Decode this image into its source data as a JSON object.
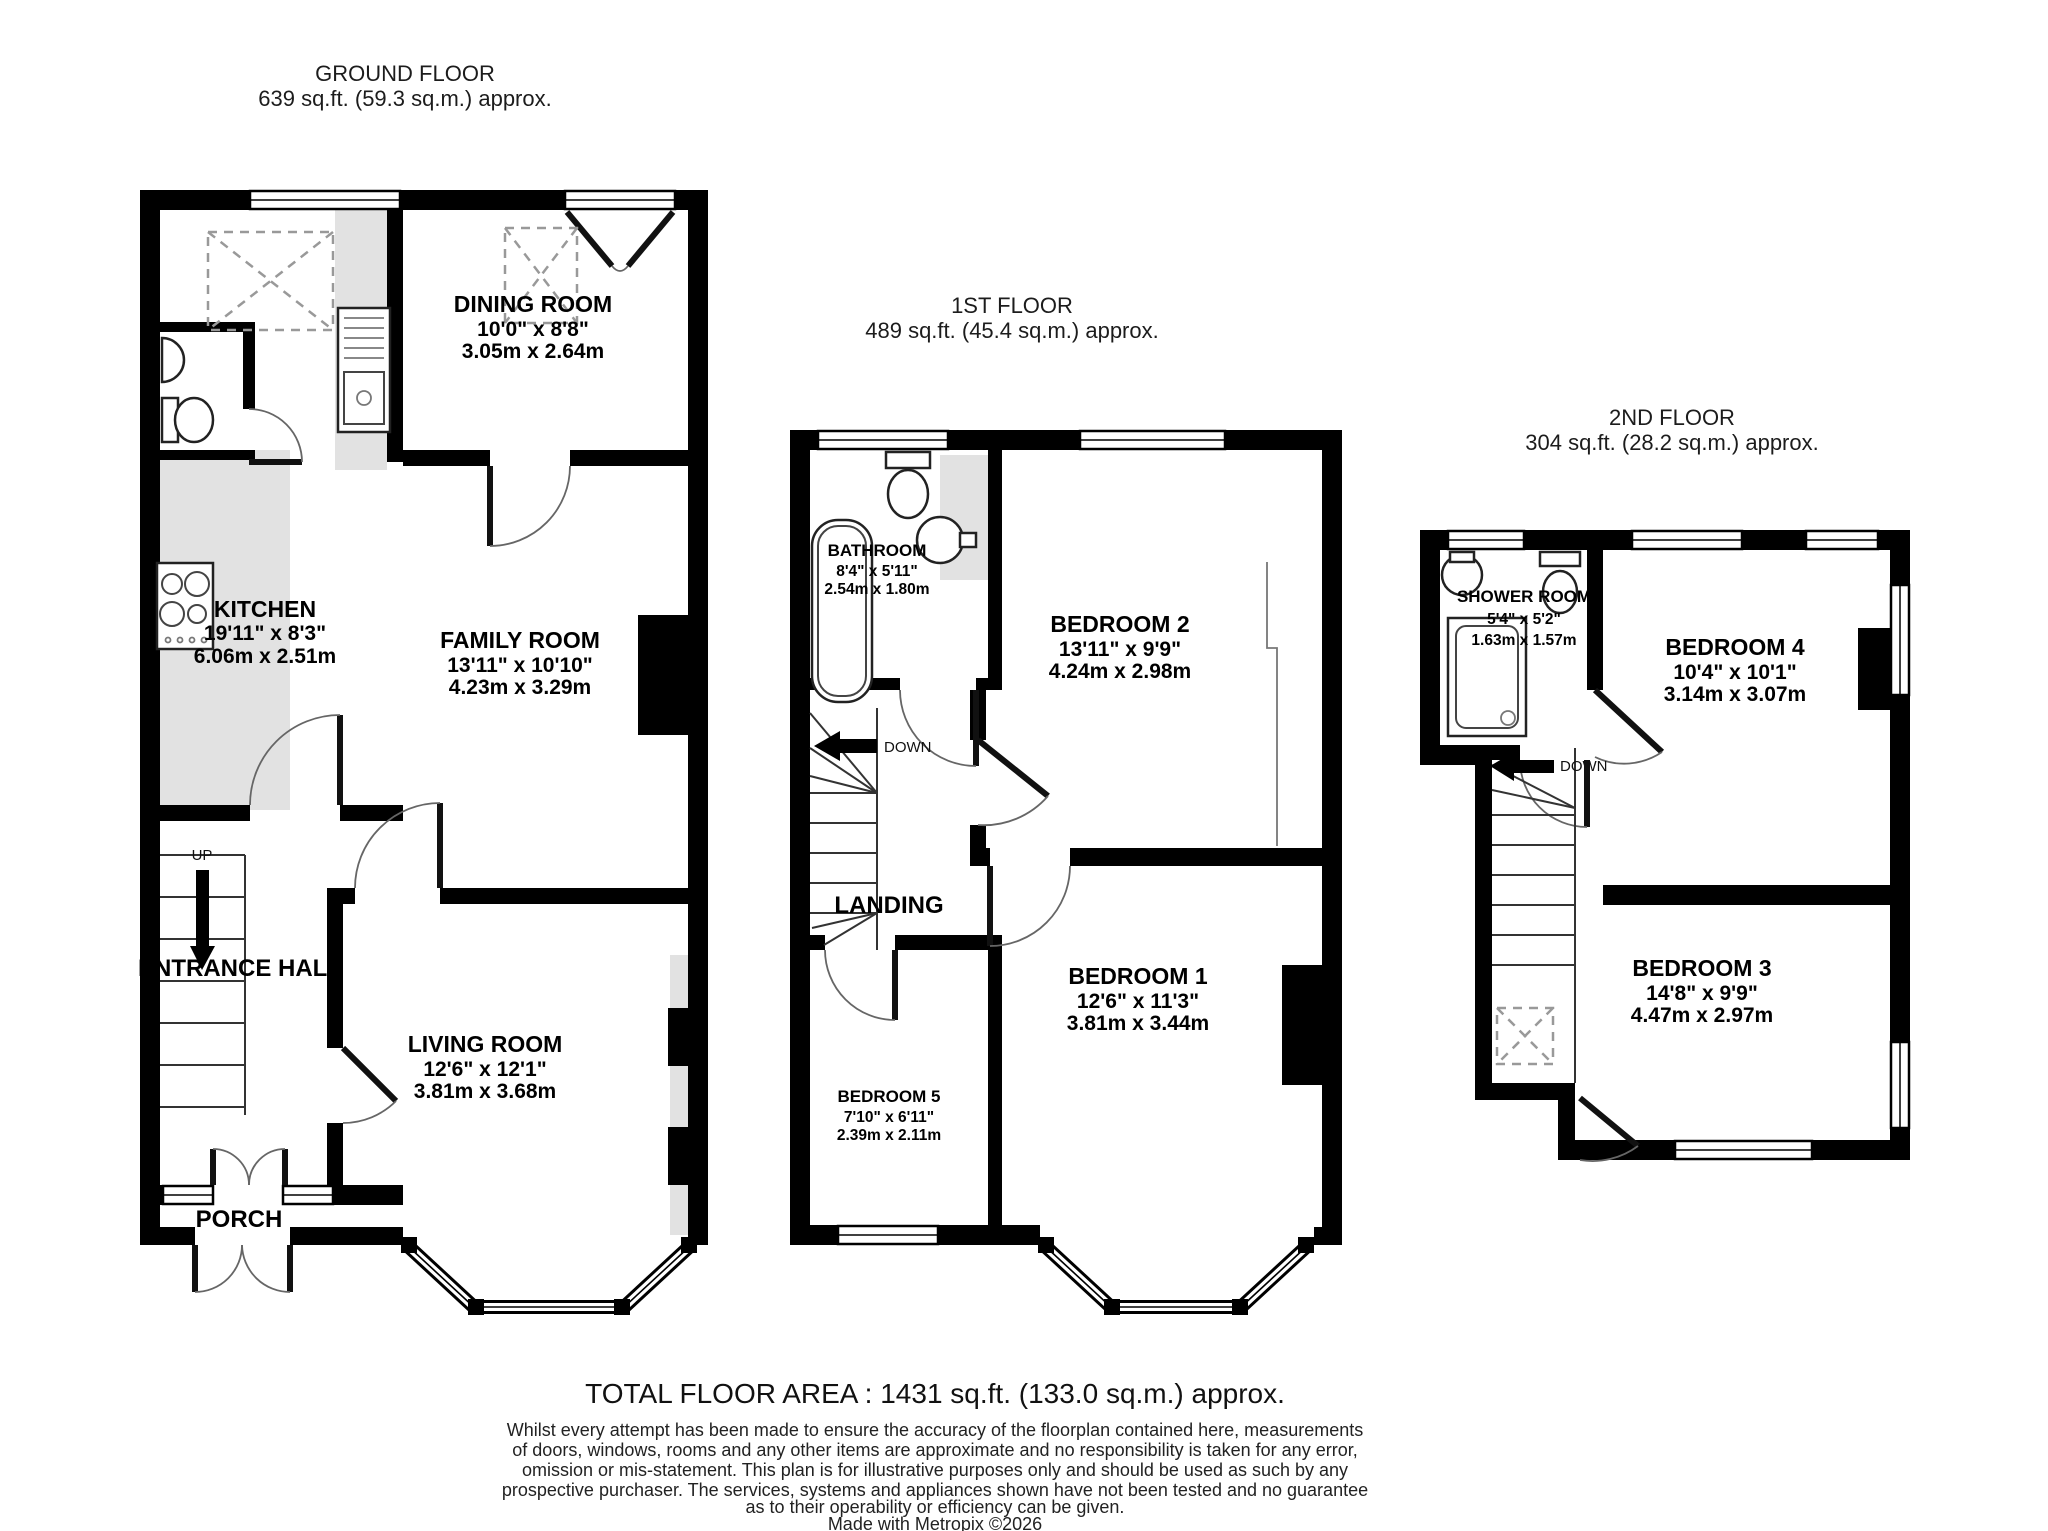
{
  "floors": [
    {
      "title": "GROUND FLOOR",
      "area": "639 sq.ft. (59.3 sq.m.) approx.",
      "stair_label": "UP",
      "rooms": [
        {
          "name": "DINING ROOM",
          "imperial": "10'0\"  x 8'8\"",
          "metric": "3.05m  x 2.64m"
        },
        {
          "name": "KITCHEN",
          "imperial": "19'11\"  x 8'3\"",
          "metric": "6.06m  x 2.51m"
        },
        {
          "name": "FAMILY ROOM",
          "imperial": "13'11\"  x 10'10\"",
          "metric": "4.23m  x 3.29m"
        },
        {
          "name": "ENTRANCE HALL"
        },
        {
          "name": "LIVING ROOM",
          "imperial": "12'6\"  x 12'1\"",
          "metric": "3.81m  x 3.68m"
        },
        {
          "name": "PORCH"
        }
      ]
    },
    {
      "title": "1ST FLOOR",
      "area": "489 sq.ft. (45.4 sq.m.) approx.",
      "stair_label": "DOWN",
      "landing_label": "LANDING",
      "rooms": [
        {
          "name": "BATHROOM",
          "imperial": "8'4\"  x 5'11\"",
          "metric": "2.54m  x 1.80m"
        },
        {
          "name": "BEDROOM 2",
          "imperial": "13'11\"  x 9'9\"",
          "metric": "4.24m  x 2.98m"
        },
        {
          "name": "BEDROOM 1",
          "imperial": "12'6\"  x 11'3\"",
          "metric": "3.81m  x 3.44m"
        },
        {
          "name": "BEDROOM 5",
          "imperial": "7'10\"  x 6'11\"",
          "metric": "2.39m  x 2.11m"
        }
      ]
    },
    {
      "title": "2ND FLOOR",
      "area": "304 sq.ft. (28.2 sq.m.) approx.",
      "stair_label": "DOWN",
      "rooms": [
        {
          "name": "SHOWER ROOM",
          "imperial": "5'4\"  x 5'2\"",
          "metric": "1.63m  x 1.57m"
        },
        {
          "name": "BEDROOM 4",
          "imperial": "10'4\"  x 10'1\"",
          "metric": "3.14m  x 3.07m"
        },
        {
          "name": "BEDROOM 3",
          "imperial": "14'8\"  x 9'9\"",
          "metric": "4.47m  x 2.97m"
        }
      ]
    }
  ],
  "footer": {
    "total": "TOTAL FLOOR AREA : 1431 sq.ft. (133.0 sq.m.) approx.",
    "disclaimer": [
      "Whilst every attempt has been made to ensure the accuracy of the floorplan contained here, measurements",
      "of doors, windows, rooms and any other items are approximate and no responsibility is taken for any error,",
      "omission or mis-statement. This plan is for illustrative purposes only and should be used as such by any",
      "prospective purchaser. The services, systems and appliances shown have not been tested and no guarantee",
      "as to their operability or efficiency can be given."
    ],
    "credit": "Made with Metropix ©2026"
  },
  "colors": {
    "wall": "#000000",
    "counter": "#e2e2e2"
  }
}
